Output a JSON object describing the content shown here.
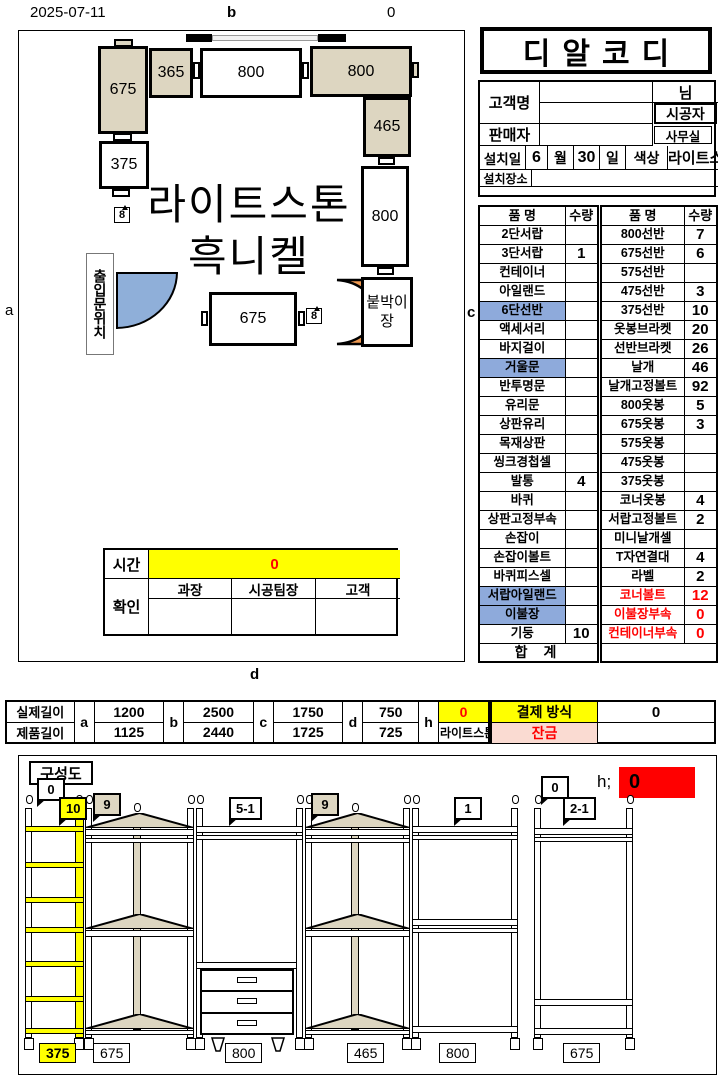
{
  "page": {
    "date": "2025-07-11",
    "label_b": "b",
    "label_top_right": "0",
    "label_a": "a",
    "label_c": "c",
    "label_d": "d"
  },
  "plan": {
    "box_675_left": "675",
    "box_365": "365",
    "box_800_top": "800",
    "box_800_right": "800",
    "box_465": "465",
    "box_375": "375",
    "box_800_mid": "800",
    "box_675_bottom": "675",
    "builtin_closet_line1": "붙박이",
    "builtin_closet_line2": "장",
    "entrance_label": "출입문위치",
    "material_line1": "라이트스톤",
    "material_line2": "흑니켈",
    "callout_left": "8",
    "callout_right": "8"
  },
  "header": {
    "title": "디알코디",
    "customer_label": "고객명",
    "customer_suffix": "님",
    "installer_label": "시공자",
    "seller_label": "판매자",
    "office_label": "사무실",
    "install_date_label": "설치일",
    "month_value": "6",
    "month_unit": "월",
    "day_value": "30",
    "day_unit": "일",
    "color_label": "색상",
    "color_value": "라이트스톤",
    "location_label": "설치장소"
  },
  "items_left": {
    "headers": {
      "name": "품 명",
      "qty": "수량"
    },
    "rows": [
      {
        "name": "2단서랍",
        "qty": "",
        "cls": ""
      },
      {
        "name": "3단서랍",
        "qty": "1",
        "cls": ""
      },
      {
        "name": "컨테이너",
        "qty": "",
        "cls": ""
      },
      {
        "name": "아일랜드",
        "qty": "",
        "cls": ""
      },
      {
        "name": "6단선반",
        "qty": "",
        "cls": "hl"
      },
      {
        "name": "액세서리",
        "qty": "",
        "cls": ""
      },
      {
        "name": "바지걸이",
        "qty": "",
        "cls": ""
      },
      {
        "name": "거울문",
        "qty": "",
        "cls": "hl"
      },
      {
        "name": "반투명문",
        "qty": "",
        "cls": ""
      },
      {
        "name": "유리문",
        "qty": "",
        "cls": ""
      },
      {
        "name": "상판유리",
        "qty": "",
        "cls": ""
      },
      {
        "name": "목재상판",
        "qty": "",
        "cls": ""
      },
      {
        "name": "씽크경첩셀",
        "qty": "",
        "cls": ""
      },
      {
        "name": "발통",
        "qty": "4",
        "cls": ""
      },
      {
        "name": "바퀴",
        "qty": "",
        "cls": ""
      },
      {
        "name": "상판고정부속",
        "qty": "",
        "cls": ""
      },
      {
        "name": "손잡이",
        "qty": "",
        "cls": ""
      },
      {
        "name": "손잡이볼트",
        "qty": "",
        "cls": ""
      },
      {
        "name": "바퀴피스셀",
        "qty": "",
        "cls": ""
      },
      {
        "name": "서랍아일랜드",
        "qty": "",
        "cls": "hl"
      },
      {
        "name": "이불장",
        "qty": "",
        "cls": "hl"
      },
      {
        "name": "기둥",
        "qty": "10",
        "cls": ""
      }
    ],
    "total_label": "합 계"
  },
  "items_right": {
    "headers": {
      "name": "품 명",
      "qty": "수량"
    },
    "rows": [
      {
        "name": "800선반",
        "qty": "7",
        "cls": ""
      },
      {
        "name": "675선반",
        "qty": "6",
        "cls": ""
      },
      {
        "name": "575선반",
        "qty": "",
        "cls": ""
      },
      {
        "name": "475선반",
        "qty": "3",
        "cls": ""
      },
      {
        "name": "375선반",
        "qty": "10",
        "cls": ""
      },
      {
        "name": "옷봉브라켓",
        "qty": "20",
        "cls": ""
      },
      {
        "name": "선반브라켓",
        "qty": "26",
        "cls": ""
      },
      {
        "name": "날개",
        "qty": "46",
        "cls": ""
      },
      {
        "name": "날개고정볼트",
        "qty": "92",
        "cls": ""
      },
      {
        "name": "800옷봉",
        "qty": "5",
        "cls": ""
      },
      {
        "name": "675옷봉",
        "qty": "3",
        "cls": ""
      },
      {
        "name": "575옷봉",
        "qty": "",
        "cls": ""
      },
      {
        "name": "475옷봉",
        "qty": "",
        "cls": ""
      },
      {
        "name": "375옷봉",
        "qty": "",
        "cls": ""
      },
      {
        "name": "코너옷봉",
        "qty": "4",
        "cls": ""
      },
      {
        "name": "서랍고정볼트",
        "qty": "2",
        "cls": ""
      },
      {
        "name": "미니날개셀",
        "qty": "",
        "cls": ""
      },
      {
        "name": "T자연결대",
        "qty": "4",
        "cls": ""
      },
      {
        "name": "라벨",
        "qty": "2",
        "cls": ""
      },
      {
        "name": "코너볼트",
        "qty": "12",
        "cls": "red"
      },
      {
        "name": "이불장부속",
        "qty": "0",
        "cls": "red"
      },
      {
        "name": "컨테이너부속",
        "qty": "0",
        "cls": "red"
      }
    ]
  },
  "time_table": {
    "time_label": "시간",
    "time_value": "0",
    "confirm_label": "확인",
    "col1": "과장",
    "col2": "시공팀장",
    "col3": "고객"
  },
  "length_table": {
    "actual_label": "실제길이",
    "product_label": "제품길이",
    "groups": [
      {
        "letter": "a",
        "actual": "1200",
        "product": "1125"
      },
      {
        "letter": "b",
        "actual": "2500",
        "product": "2440"
      },
      {
        "letter": "c",
        "actual": "1750",
        "product": "1725"
      },
      {
        "letter": "d",
        "actual": "750",
        "product": "725"
      },
      {
        "letter": "h",
        "actual": "0",
        "product": "라이트스톤"
      }
    ]
  },
  "payment": {
    "method_label": "결제 방식",
    "method_value": "0",
    "balance_label": "잔금",
    "balance_value": ""
  },
  "composition": {
    "title": "구성도",
    "callouts": [
      "0",
      "10",
      "9",
      "5-1",
      "9",
      "1",
      "0",
      "2-1"
    ],
    "h_label": "h;",
    "h_value": "0",
    "unit_labels": [
      "375",
      "675",
      "800",
      "465",
      "800",
      "675"
    ]
  }
}
